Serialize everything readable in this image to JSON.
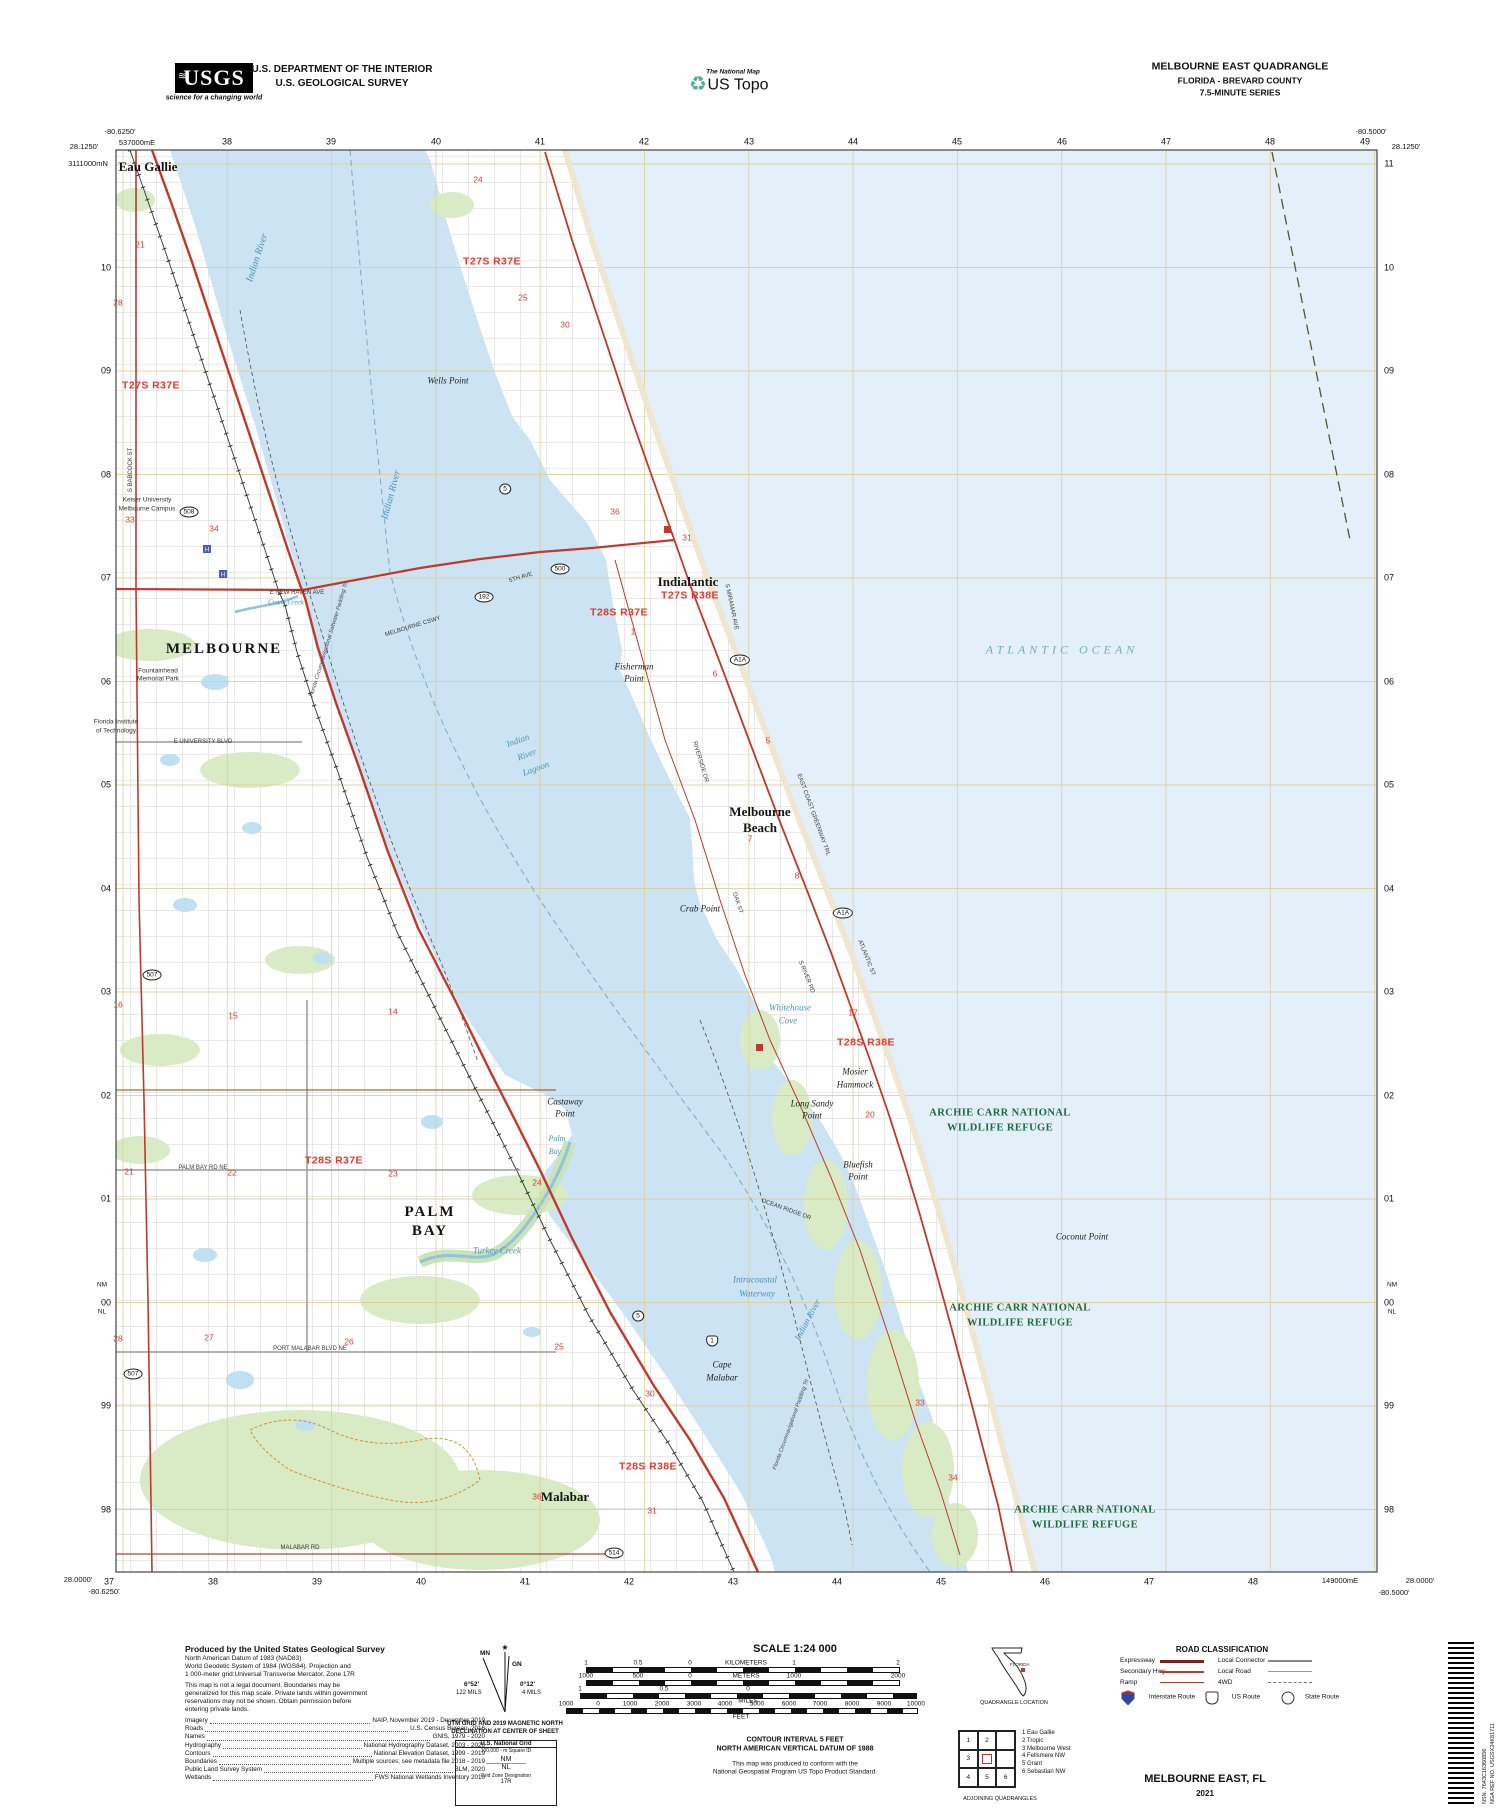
{
  "colors": {
    "river": "#cbe3f2",
    "ocean": "#e4f0f9",
    "grid": "#dccf96",
    "road_red": "#c0392b",
    "expressway": "#8e2418",
    "green_area": "#d8ebc5",
    "refuge_text": "#1b6b3c",
    "township_text": "#e5382e",
    "water_text": "#4d94b8"
  },
  "header": {
    "usgs_logo": "USGS",
    "usgs_tagline": "science for a changing world",
    "dept_line1": "U.S. DEPARTMENT OF THE INTERIOR",
    "dept_line2": "U.S. GEOLOGICAL SURVEY",
    "ustopo_small": "The National Map",
    "ustopo_large": "US Topo",
    "quad_title": "MELBOURNE EAST QUADRANGLE",
    "quad_subtitle": "FLORIDA - BREVARD COUNTY",
    "quad_series": "7.5-MINUTE SERIES"
  },
  "map": {
    "corner_coords": {
      "tl_lon": "-80.6250'",
      "tl_lat": "28.1250'",
      "tr_lon": "-80.5000'",
      "tr_lat": "28.1250'",
      "bl_lat": "28.0000'",
      "bl_lon": "-80.6250'",
      "br_lat": "28.0000'",
      "br_lon": "-80.5000'",
      "first_easting": "537000mE",
      "last_easting": "149000mE",
      "first_northing": "3111000mN"
    },
    "top_numbers": [
      [
        "38",
        227
      ],
      [
        "39",
        331
      ],
      [
        "40",
        436
      ],
      [
        "41",
        540
      ],
      [
        "42",
        644
      ],
      [
        "43",
        749
      ],
      [
        "44",
        853
      ],
      [
        "45",
        957
      ],
      [
        "46",
        1062
      ],
      [
        "47",
        1166
      ],
      [
        "48",
        1270
      ],
      [
        "49",
        1365
      ]
    ],
    "bottom_numbers": [
      [
        "37",
        109
      ],
      [
        "38",
        213
      ],
      [
        "39",
        317
      ],
      [
        "40",
        421
      ],
      [
        "41",
        525
      ],
      [
        "42",
        629
      ],
      [
        "43",
        733
      ],
      [
        "44",
        837
      ],
      [
        "45",
        941
      ],
      [
        "46",
        1045
      ],
      [
        "47",
        1149
      ],
      [
        "48",
        1253
      ]
    ],
    "left_numbers": [
      [
        "10",
        268
      ],
      [
        "09",
        371
      ],
      [
        "08",
        475
      ],
      [
        "07",
        578
      ],
      [
        "06",
        682
      ],
      [
        "05",
        785
      ],
      [
        "04",
        889
      ],
      [
        "03",
        992
      ],
      [
        "02",
        1096
      ],
      [
        "01",
        1199
      ],
      [
        "00",
        1303
      ],
      [
        "99",
        1406
      ],
      [
        "98",
        1510
      ]
    ],
    "right_numbers": [
      [
        "11",
        164
      ],
      [
        "10",
        268
      ],
      [
        "09",
        371
      ],
      [
        "08",
        475
      ],
      [
        "07",
        578
      ],
      [
        "06",
        682
      ],
      [
        "05",
        785
      ],
      [
        "04",
        889
      ],
      [
        "03",
        992
      ],
      [
        "02",
        1096
      ],
      [
        "01",
        1199
      ],
      [
        "00",
        1303
      ],
      [
        "99",
        1406
      ],
      [
        "98",
        1510
      ]
    ],
    "usng_edge": [
      [
        "NM",
        102,
        1286
      ],
      [
        "NL",
        102,
        1313
      ],
      [
        "NM",
        1392,
        1286
      ],
      [
        "NL",
        1392,
        1313
      ]
    ],
    "labels": {
      "places_large": [
        [
          "MELBOURNE",
          224,
          650
        ],
        [
          "PALM",
          430,
          1213
        ],
        [
          "BAY",
          430,
          1232
        ]
      ],
      "places": [
        [
          "Eau Gallie",
          148,
          167
        ],
        [
          "Indialantic",
          688,
          582
        ],
        [
          "Melbourne",
          760,
          812
        ],
        [
          "Beach",
          760,
          828
        ],
        [
          "Malabar",
          565,
          1497
        ]
      ],
      "points": [
        [
          "Wells Point",
          448,
          381
        ],
        [
          "Fisherman",
          634,
          667
        ],
        [
          "Point",
          634,
          679
        ],
        [
          "Crab Point",
          700,
          909
        ],
        [
          "Castaway",
          565,
          1102
        ],
        [
          "Point",
          565,
          1114
        ],
        [
          "Long Sandy",
          812,
          1104
        ],
        [
          "Point",
          812,
          1116
        ],
        [
          "Bluefish",
          858,
          1165
        ],
        [
          "Point",
          858,
          1177
        ],
        [
          "Cape",
          722,
          1365
        ],
        [
          "Malabar",
          722,
          1378
        ],
        [
          "Coconut Point",
          1082,
          1237
        ],
        [
          "Mosier",
          855,
          1072
        ],
        [
          "Hammock",
          855,
          1085
        ]
      ],
      "institutions": [
        [
          "Keiser University",
          147,
          501
        ],
        [
          "Melbourne Campus",
          147,
          510
        ],
        [
          "Florida Institute",
          116,
          723
        ],
        [
          "of Technology",
          116,
          732
        ],
        [
          "Fountainhead",
          158,
          672
        ],
        [
          "Memorial Park",
          158,
          680
        ]
      ],
      "water": [
        [
          "Indian River",
          258,
          258,
          -72,
          10
        ],
        [
          "Indian River",
          392,
          495,
          -75,
          10
        ],
        [
          "Indian",
          518,
          741,
          -20,
          9
        ],
        [
          "River",
          527,
          755,
          -20,
          9
        ],
        [
          "Lagoon",
          536,
          769,
          -20,
          9
        ],
        [
          "Indian River",
          808,
          1320,
          -62,
          9
        ],
        [
          "Crane Creek",
          286,
          603,
          0,
          7
        ],
        [
          "Turkey Creek",
          497,
          1251,
          0,
          9
        ],
        [
          "Palm",
          557,
          1139,
          0,
          8
        ],
        [
          "Bay",
          555,
          1152,
          0,
          8
        ],
        [
          "Intracoastal",
          755,
          1280,
          0,
          9
        ],
        [
          "Waterway",
          757,
          1294,
          0,
          9
        ],
        [
          "Whitehouse",
          790,
          1008,
          0,
          9
        ],
        [
          "Cove",
          788,
          1021,
          0,
          9
        ]
      ],
      "ocean_label": [
        [
          "ATLANTIC OCEAN",
          1062,
          650
        ]
      ],
      "townships": [
        [
          "T27S R37E",
          151,
          386
        ],
        [
          "T27S R37E",
          492,
          262
        ],
        [
          "T28S R37E",
          619,
          613
        ],
        [
          "T27S R38E",
          690,
          596
        ],
        [
          "T28S R38E",
          866,
          1043
        ],
        [
          "T28S R37E",
          334,
          1161
        ],
        [
          "T28S R38E",
          648,
          1467
        ]
      ],
      "sections": [
        [
          "21",
          140,
          245
        ],
        [
          "28",
          118,
          303
        ],
        [
          "24",
          478,
          180
        ],
        [
          "25",
          523,
          298
        ],
        [
          "30",
          565,
          325
        ],
        [
          "33",
          130,
          520
        ],
        [
          "34",
          214,
          529
        ],
        [
          "36",
          615,
          512
        ],
        [
          "31",
          687,
          538
        ],
        [
          "1",
          633,
          632
        ],
        [
          "6",
          715,
          674
        ],
        [
          "5",
          768,
          741
        ],
        [
          "7",
          750,
          839
        ],
        [
          "8",
          797,
          876
        ],
        [
          "17",
          853,
          1013
        ],
        [
          "20",
          870,
          1115
        ],
        [
          "16",
          118,
          1005
        ],
        [
          "15",
          233,
          1016
        ],
        [
          "14",
          393,
          1012
        ],
        [
          "21",
          129,
          1172
        ],
        [
          "22",
          232,
          1173
        ],
        [
          "23",
          393,
          1174
        ],
        [
          "24",
          537,
          1183
        ],
        [
          "25",
          559,
          1347
        ],
        [
          "26",
          349,
          1342
        ],
        [
          "27",
          209,
          1338
        ],
        [
          "28",
          118,
          1339
        ],
        [
          "30",
          650,
          1394
        ],
        [
          "36",
          537,
          1497
        ],
        [
          "31",
          652,
          1511
        ],
        [
          "33",
          920,
          1403
        ],
        [
          "34",
          953,
          1478
        ]
      ],
      "refuge": [
        [
          "ARCHIE CARR NATIONAL",
          1000,
          1113
        ],
        [
          "WILDLIFE REFUGE",
          1000,
          1128
        ],
        [
          "ARCHIE CARR NATIONAL",
          1020,
          1308
        ],
        [
          "WILDLIFE REFUGE",
          1020,
          1323
        ],
        [
          "ARCHIE CARR NATIONAL",
          1085,
          1510
        ],
        [
          "WILDLIFE REFUGE",
          1085,
          1525
        ]
      ],
      "streets": [
        [
          "MELBOURNE CSWY",
          413,
          627,
          -17
        ],
        [
          "5TH AVE",
          521,
          578,
          -17
        ],
        [
          "E NEW HAVEN AVE",
          297,
          593
        ],
        [
          "S BABCOCK ST",
          131,
          470,
          -90
        ],
        [
          "ATLANTIC ST",
          866,
          958,
          68
        ],
        [
          "EAST COAST GREENWAY TRL",
          813,
          815,
          70
        ],
        [
          "RIVERSIDE DR",
          700,
          762,
          73
        ],
        [
          "S MIRAMAR AVE",
          731,
          607,
          78
        ],
        [
          "S RIVER RD",
          806,
          977,
          68
        ],
        [
          "OCEAN RIDGE DR",
          786,
          1210,
          20
        ],
        [
          "PALM BAY RD NE",
          203,
          1168
        ],
        [
          "PORT MALABAR BLVD NE",
          310,
          1349
        ],
        [
          "E UNIVERSITY BLVD",
          203,
          742
        ],
        [
          "MALABAR RD",
          300,
          1548
        ],
        [
          "OAK ST",
          737,
          903,
          72
        ]
      ],
      "trails": [
        [
          "Florida Circumnavigational Saltwater Paddling Trl",
          330,
          640,
          -73
        ],
        [
          "Florida Circumnavigational Paddling Trl",
          792,
          1425,
          -70
        ]
      ]
    },
    "shields": [
      [
        "192",
        484,
        597,
        "oval"
      ],
      [
        "500",
        560,
        569,
        "oval"
      ],
      [
        "508",
        189,
        512,
        "oval"
      ],
      [
        "507",
        152,
        975,
        "oval"
      ],
      [
        "507",
        133,
        1374,
        "oval"
      ],
      [
        "A1A",
        740,
        660,
        "oval"
      ],
      [
        "A1A",
        843,
        913,
        "oval"
      ],
      [
        "5",
        505,
        489,
        "oval"
      ],
      [
        "5",
        638,
        1316,
        "oval"
      ],
      [
        "514",
        614,
        1553,
        "oval"
      ],
      [
        "1",
        712,
        1341,
        "us"
      ]
    ]
  },
  "footer": {
    "produced_title": "Produced by the United States Geological Survey",
    "datum_lines": [
      "North American Datum of 1983 (NAD83)",
      "World Geodetic System of 1984 (WGS84).  Projection and",
      "1 000-meter grid:Universal Transverse Mercator, Zone 17R"
    ],
    "legal_lines": [
      "This map is not a legal document. Boundaries may be",
      "generalized for this map scale. Private lands within government",
      "reservations may not be shown. Obtain permission before",
      "entering private lands."
    ],
    "credits": [
      [
        "Imagery",
        "NAIP, November 2019 - December 2019"
      ],
      [
        "Roads",
        "U.S. Census Bureau, 2016"
      ],
      [
        "Names",
        "GNIS, 1979 - 2020"
      ],
      [
        "Hydrography",
        "National Hydrography Dataset, 2003 - 2020"
      ],
      [
        "Contours",
        "National Elevation Dataset, 1999 - 2019"
      ],
      [
        "Boundaries",
        "Multiple sources; see metadata file 2018 - 2019"
      ],
      [
        "Public Land Survey System",
        "BLM, 2020"
      ],
      [
        "Wetlands",
        "FWS National Wetlands Inventory 2010"
      ]
    ],
    "declination": {
      "mn": "MN",
      "gn": "GN",
      "left_deg": "6°52'",
      "left_mils": "122 MILS",
      "right_deg": "0°12'",
      "right_mils": "4 MILS",
      "caption1": "UTM GRID AND 2019 MAGNETIC NORTH",
      "caption2": "DECLINATION AT CENTER OF SHEET"
    },
    "usng": {
      "title": "U.S. National Grid",
      "sub": "100,000 - m Square ID",
      "sq_top": "NM",
      "sq_bottom": "NL",
      "tick": "'00",
      "zone_label": "Grid Zone Designation",
      "zone": "17R"
    },
    "scale_title": "SCALE 1:24 000",
    "scale_labels": [
      [
        "1",
        586,
        1663
      ],
      [
        "0.5",
        638,
        1663
      ],
      [
        "0",
        690,
        1663
      ],
      [
        "KILOMETERS",
        746,
        1663
      ],
      [
        "1",
        794,
        1663
      ],
      [
        "2",
        898,
        1663
      ],
      [
        "1000",
        586,
        1676
      ],
      [
        "500",
        638,
        1676
      ],
      [
        "0",
        690,
        1676
      ],
      [
        "METERS",
        746,
        1676
      ],
      [
        "1000",
        794,
        1676
      ],
      [
        "2000",
        898,
        1676
      ],
      [
        "1",
        580,
        1689
      ],
      [
        "0.5",
        664,
        1689
      ],
      [
        "0",
        748,
        1689
      ],
      [
        "MILES",
        748,
        1701
      ],
      [
        "1000",
        566,
        1704
      ],
      [
        "0",
        598,
        1704
      ],
      [
        "1000",
        630,
        1704
      ],
      [
        "2000",
        662,
        1704
      ],
      [
        "3000",
        694,
        1704
      ],
      [
        "4000",
        725,
        1704
      ],
      [
        "5000",
        757,
        1704
      ],
      [
        "6000",
        789,
        1704
      ],
      [
        "7000",
        820,
        1704
      ],
      [
        "8000",
        852,
        1704
      ],
      [
        "9000",
        884,
        1704
      ],
      [
        "10000",
        916,
        1704
      ],
      [
        "FEET",
        741,
        1717
      ]
    ],
    "contour_lines": [
      "CONTOUR INTERVAL 5 FEET",
      "NORTH AMERICAN VERTICAL DATUM OF 1988"
    ],
    "standard_lines": [
      "This map was produced to conform with the",
      "National Geospatial Program US Topo Product Standard."
    ],
    "quad_location": "QUADRANGLE LOCATION",
    "state_name": "FLORIDA",
    "adjoining": {
      "caption": "ADJOINING QUADRANGLES",
      "grid": [
        "1",
        "2",
        "",
        "3",
        "",
        "",
        "4",
        "5",
        "6"
      ],
      "list": [
        "1 Eau Gallie",
        "2 Tropic",
        "3 Melbourne West",
        "4 Fellsmere NW",
        "5 Grant",
        "6 Sebastian NW"
      ]
    },
    "road_class": {
      "title": "ROAD CLASSIFICATION",
      "rows": [
        [
          "Expressway",
          "expwy",
          "Local Connector",
          "conn"
        ],
        [
          "Secondary Hwy",
          "sec",
          "Local Road",
          "local"
        ],
        [
          "Ramp",
          "ramp",
          "4WD",
          "fourwd"
        ]
      ],
      "shield_items": [
        "Interstate Route",
        "US Route",
        "State Route"
      ]
    },
    "imprint_name": "MELBOURNE EAST,  FL",
    "imprint_year": "2021",
    "barcode_nsn": "NSN.  7643C16360856",
    "barcode_nga": "NGA REF NO.  USGSX24K81711"
  }
}
